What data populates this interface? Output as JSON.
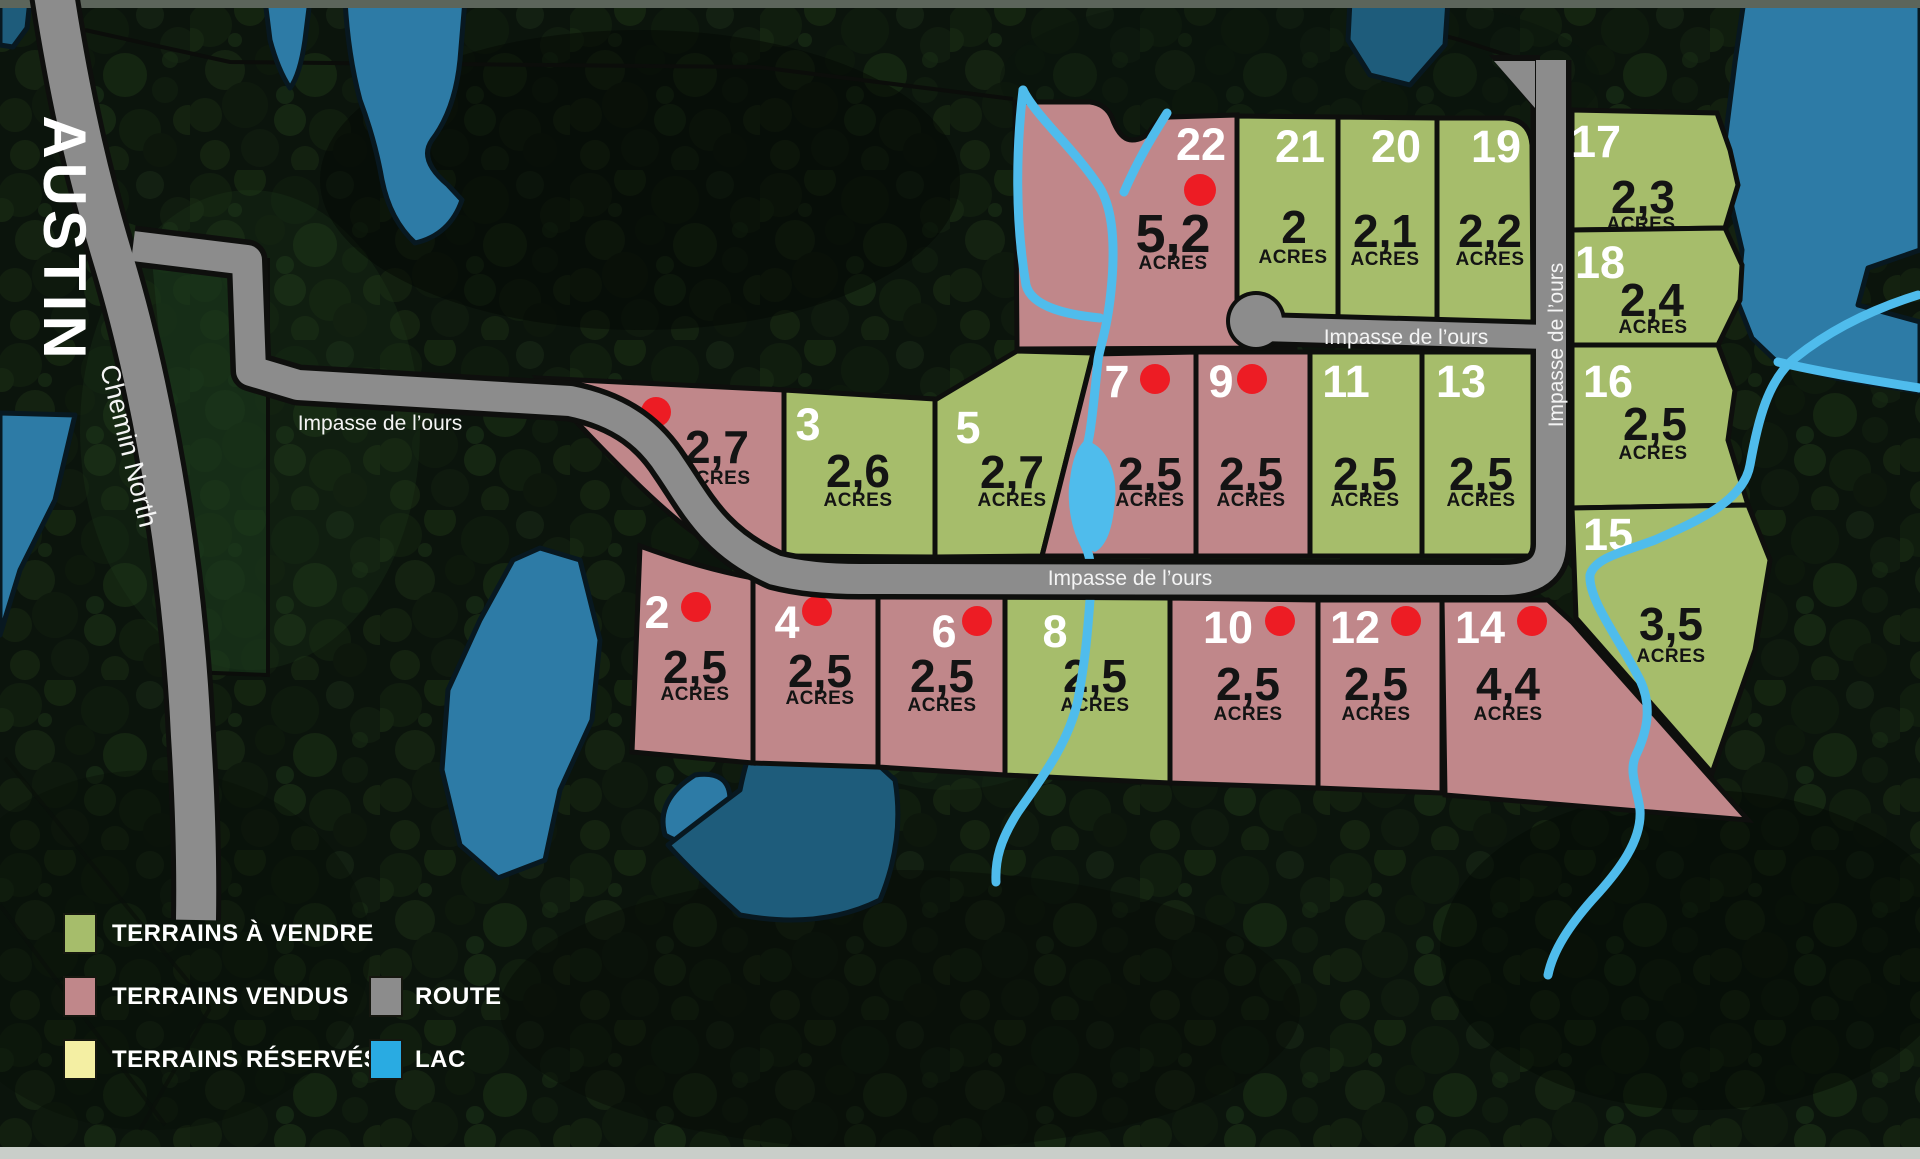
{
  "map": {
    "region_label": "AUSTIN",
    "road_chemin": "Chemin North",
    "road_impasse": "Impasse de l’ours",
    "acres_unit": "ACRES"
  },
  "lots": [
    {
      "number": "1",
      "acreage": "2,7",
      "status": "sold"
    },
    {
      "number": "2",
      "acreage": "2,5",
      "status": "sold"
    },
    {
      "number": "3",
      "acreage": "2,6",
      "status": "for_sale"
    },
    {
      "number": "4",
      "acreage": "2,5",
      "status": "sold"
    },
    {
      "number": "5",
      "acreage": "2,7",
      "status": "for_sale"
    },
    {
      "number": "6",
      "acreage": "2,5",
      "status": "sold"
    },
    {
      "number": "7",
      "acreage": "2,5",
      "status": "sold"
    },
    {
      "number": "8",
      "acreage": "2,5",
      "status": "for_sale"
    },
    {
      "number": "9",
      "acreage": "2,5",
      "status": "sold"
    },
    {
      "number": "10",
      "acreage": "2,5",
      "status": "sold"
    },
    {
      "number": "11",
      "acreage": "2,5",
      "status": "for_sale"
    },
    {
      "number": "12",
      "acreage": "2,5",
      "status": "sold"
    },
    {
      "number": "13",
      "acreage": "2,5",
      "status": "for_sale"
    },
    {
      "number": "14",
      "acreage": "4,4",
      "status": "sold"
    },
    {
      "number": "15",
      "acreage": "3,5",
      "status": "for_sale"
    },
    {
      "number": "16",
      "acreage": "2,5",
      "status": "for_sale"
    },
    {
      "number": "17",
      "acreage": "2,3",
      "status": "for_sale"
    },
    {
      "number": "18",
      "acreage": "2,4",
      "status": "for_sale"
    },
    {
      "number": "19",
      "acreage": "2,2",
      "status": "for_sale"
    },
    {
      "number": "20",
      "acreage": "2,1",
      "status": "for_sale"
    },
    {
      "number": "21",
      "acreage": "2",
      "status": "for_sale"
    },
    {
      "number": "22",
      "acreage": "5,2",
      "status": "sold"
    }
  ],
  "legend": {
    "items": [
      {
        "label": "TERRAINS À VENDRE",
        "color": "#a6bd6b"
      },
      {
        "label": "TERRAINS VENDUS",
        "color": "#c0878a"
      },
      {
        "label": "TERRAINS RÉSERVÉS",
        "color": "#f4efa3"
      },
      {
        "label": "ROUTE",
        "color": "#8c8c8c"
      },
      {
        "label": "LAC",
        "color": "#29abe2"
      }
    ]
  },
  "colors": {
    "for_sale": "#a6bd6b",
    "sold": "#c0878a",
    "road": "#8c8c8c",
    "dot": "#ed1c24",
    "lake": "#2d7ba6",
    "lake_dark": "#1e5c7b",
    "stream": "#4fbcec"
  }
}
